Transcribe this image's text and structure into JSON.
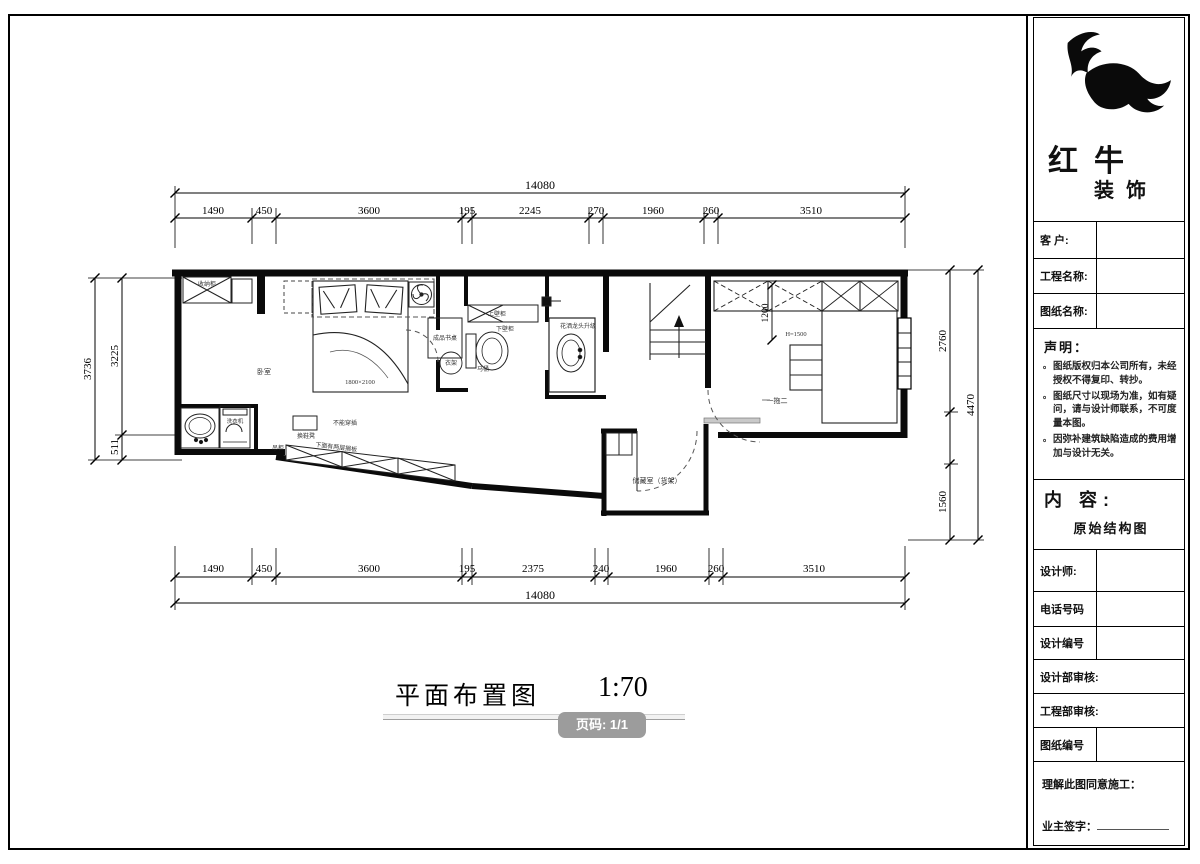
{
  "title_block": {
    "brand": {
      "name_line1": "红牛",
      "name_line2": "装饰"
    },
    "fields": {
      "customer": "客  户:",
      "project_name": "工程名称:",
      "drawing_name": "图纸名称:",
      "designer": "设计师:",
      "phone": "电话号码",
      "design_no": "设计编号",
      "design_dept_review": "设计部审核:",
      "engineering_dept_review": "工程部审核:",
      "drawing_no": "图纸编号"
    },
    "statement": {
      "heading": "声明：",
      "items": [
        "图纸版权归本公司所有，未经授权不得复印、转抄。",
        "图纸尺寸以现场为准，如有疑问，请与设计师联系，不可度量本图。",
        "因弥补建筑缺陷造成的费用增加与设计无关。"
      ]
    },
    "content": {
      "heading": "内  容:",
      "value": "原始结构图"
    },
    "footer": {
      "agreement": "理解此图同意施工：",
      "owner_sign": "业主签字："
    }
  },
  "drawing": {
    "title": "平面布置图",
    "scale": "1:70",
    "page_badge": "页码: 1/1",
    "dims": {
      "top_total": "14080",
      "top_segments": [
        "1490",
        "450",
        "3600",
        "195",
        "2245",
        "270",
        "1960",
        "260",
        "3510"
      ],
      "bottom_segments": [
        "1490",
        "450",
        "3600",
        "195",
        "2375",
        "240",
        "1960",
        "260",
        "3510"
      ],
      "bottom_total": "14080",
      "left_total": "3736",
      "left_upper": "3225",
      "left_lower": "511",
      "right_upper": "2760",
      "right_lower": "1560",
      "right_total": "4470",
      "closet_depth": "1200",
      "closet_height": "H=1500"
    },
    "labels": {
      "bedroom": "卧室",
      "bed_size": "1800×2100",
      "top_cabinet": "收纳柜",
      "desk": "成品书桌",
      "hanger": "衣架",
      "upper_cabinet": "上壁柜",
      "lower_cabinet": "下壁柜",
      "toilet": "马桶",
      "shower_note": "花洒龙头升级",
      "washer": "洗衣机",
      "ac_unit": "一拖二",
      "storage_room": "储藏室（货架）",
      "hall_cabinet": "吊柜",
      "shoe_stool": "换鞋凳",
      "band_note_top": "不能穿插",
      "band_note_bottom": "下面有两层搁板"
    }
  }
}
